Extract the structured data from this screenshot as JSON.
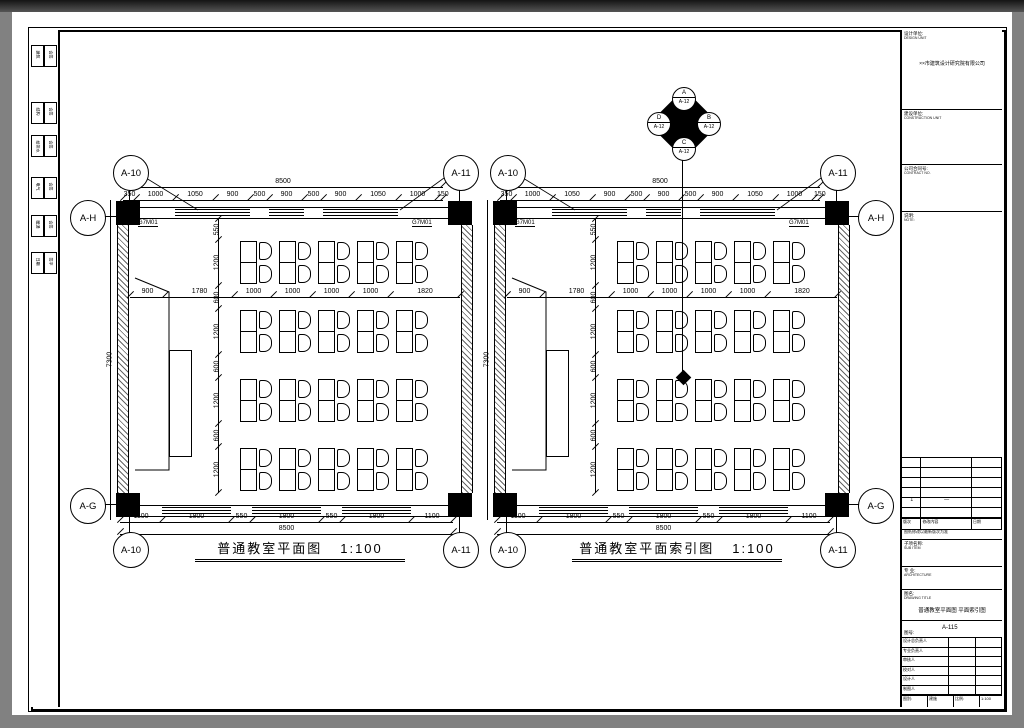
{
  "plans": [
    {
      "title": "普通教室平面图",
      "scale": "1:100",
      "side": "left",
      "door_mark": "G7M01",
      "bubbles": {
        "top_left": "A-10",
        "top_right": "A-11",
        "side_top": "A-H",
        "side_bottom": "A-G",
        "bottom_left": "A-10",
        "bottom_right": "A-11"
      },
      "dims": {
        "top_total": "8500",
        "top": [
          "350",
          "1000",
          "1050",
          "900",
          "500",
          "900",
          "500",
          "900",
          "1050",
          "1000",
          "150"
        ],
        "mid": [
          "900",
          "1780",
          "1000",
          "1000",
          "1000",
          "1000",
          "1820"
        ],
        "left_total": "7300",
        "left": [
          "550",
          "1200",
          "600",
          "1200",
          "600",
          "1200",
          "600",
          "1200"
        ],
        "bottom": [
          "1100",
          "1800",
          "550",
          "1800",
          "550",
          "1800",
          "1100"
        ],
        "bottom_total": "8500"
      },
      "index_diamond": false
    },
    {
      "title": "普通教室平面索引图",
      "scale": "1:100",
      "side": "right",
      "door_mark": "G7M01",
      "bubbles": {
        "top_left": "A-10",
        "top_right": "A-11",
        "side_top": "A-H",
        "side_bottom": "A-G",
        "bottom_left": "A-10",
        "bottom_right": "A-11"
      },
      "dims": {
        "top_total": "8500",
        "top": [
          "350",
          "1000",
          "1050",
          "900",
          "500",
          "900",
          "500",
          "900",
          "1050",
          "1000",
          "150"
        ],
        "mid": [
          "900",
          "1780",
          "1000",
          "1000",
          "1000",
          "1000",
          "1820"
        ],
        "left_total": "7300",
        "left": [
          "550",
          "1200",
          "600",
          "1200",
          "600",
          "1200",
          "600",
          "1200"
        ],
        "bottom": [
          "1100",
          "1800",
          "550",
          "1800",
          "550",
          "1800",
          "1100"
        ],
        "bottom_total": "8500"
      },
      "index_diamond": true
    }
  ],
  "index_symbol": {
    "nodes": [
      {
        "pos": "top",
        "letter": "A",
        "ref": "A-12"
      },
      {
        "pos": "right",
        "letter": "B",
        "ref": "A-12"
      },
      {
        "pos": "bottom",
        "letter": "C",
        "ref": "A-12"
      },
      {
        "pos": "left",
        "letter": "D",
        "ref": "A-12"
      }
    ]
  },
  "signbar": {
    "rows": [
      [
        "建筑",
        "会签"
      ],
      [
        "结构",
        "会签"
      ],
      [
        "给排水",
        "会签"
      ],
      [
        "电气",
        "会签"
      ],
      [
        "暖通",
        "会签"
      ],
      [
        "日期",
        "签字"
      ]
    ]
  },
  "titleblock": {
    "design_unit_label": "设计单位:",
    "design_unit_sub": "DESIGN UNIT",
    "design_unit_name": "××市建筑设计研究院有限公司",
    "owner_label": "建设单位:",
    "owner_sub": "CONSTRUCTION UNIT",
    "contract_label": "公司合同号:",
    "contract_sub": "CONTRACT NO.",
    "note_label": "说明:",
    "note_sub": "NOTE:",
    "rev_mark": "1",
    "rev_dash": "—",
    "rev_header": [
      "版次",
      "修改内容",
      "日期"
    ],
    "rev_note": "图纸修改以最新版次为准",
    "subitem_label": "子项名称:",
    "subitem_sub": "SUB ITEM",
    "major_label": "专 业:",
    "major_sub": "ARCHITECTURE",
    "dwg_title_label": "图名:",
    "dwg_title_sub": "DRAWING TITLE",
    "dwg_title": "普通教室平面图 平面索引图",
    "dwg_no_label": "图号:",
    "dwg_no_sub": "DWG NO.",
    "dwg_no": "A-115",
    "sign_rows": [
      "设计总负责人",
      "专业负责人",
      "审核人",
      "校对人",
      "设计人",
      "制图人"
    ],
    "meta_type_label": "图别:",
    "meta_type": "建施",
    "meta_scale_label": "比例:",
    "meta_scale": "1:100",
    "meta_date_label": "日期:",
    "meta_appr_label": "审定号:"
  }
}
